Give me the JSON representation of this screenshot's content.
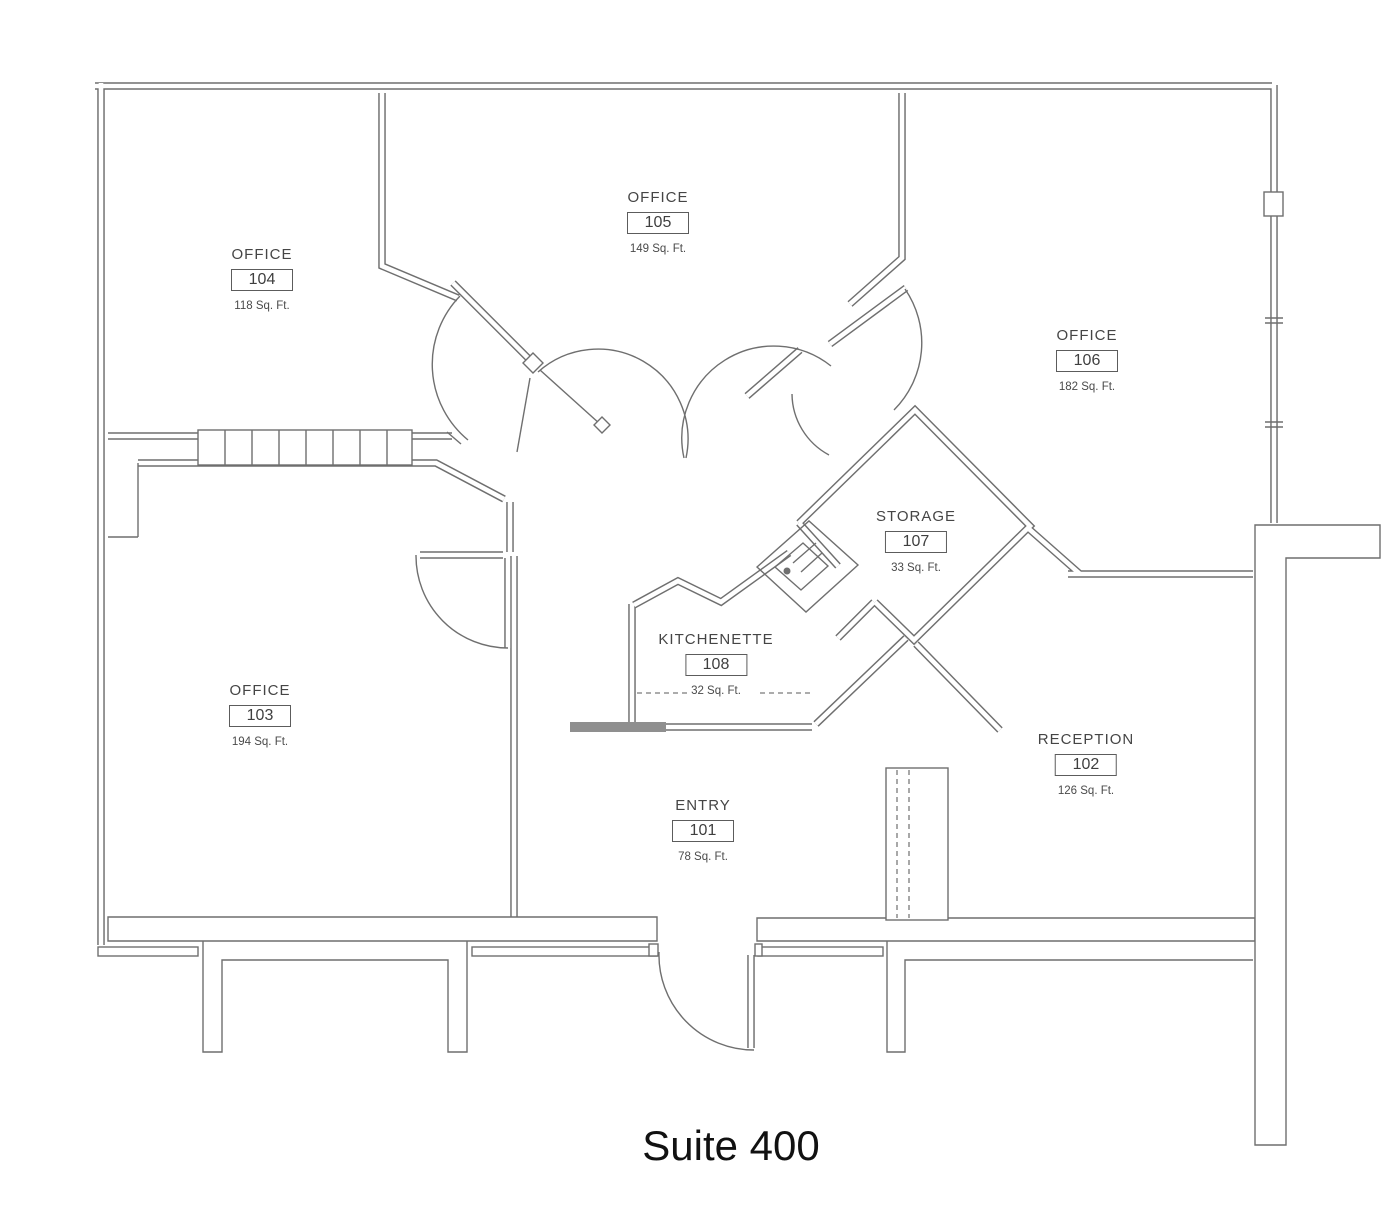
{
  "title": "Suite 400",
  "rooms": {
    "r101": {
      "name": "ENTRY",
      "number": "101",
      "area": "78 Sq. Ft."
    },
    "r102": {
      "name": "RECEPTION",
      "number": "102",
      "area": "126 Sq. Ft."
    },
    "r103": {
      "name": "OFFICE",
      "number": "103",
      "area": "194 Sq. Ft."
    },
    "r104": {
      "name": "OFFICE",
      "number": "104",
      "area": "118 Sq. Ft."
    },
    "r105": {
      "name": "OFFICE",
      "number": "105",
      "area": "149 Sq. Ft."
    },
    "r106": {
      "name": "OFFICE",
      "number": "106",
      "area": "182 Sq. Ft."
    },
    "r107": {
      "name": "STORAGE",
      "number": "107",
      "area": "33 Sq. Ft."
    },
    "r108": {
      "name": "KITCHENETTE",
      "number": "108",
      "area": "32 Sq. Ft."
    }
  },
  "colors": {
    "wall_line": "#6f6f6f",
    "text": "#3f3f3f",
    "background": "#ffffff"
  }
}
